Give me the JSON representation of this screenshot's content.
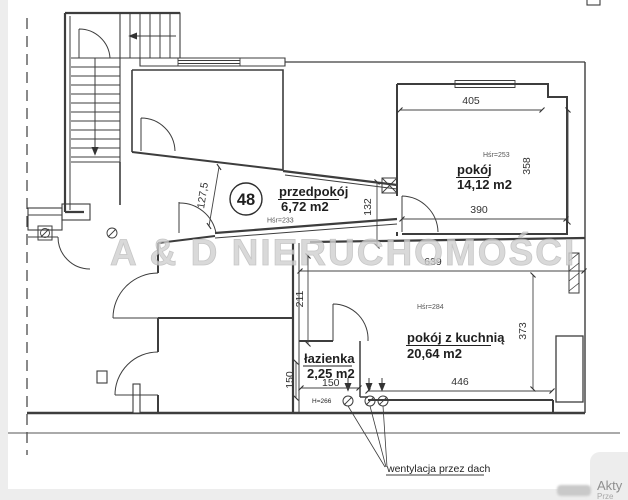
{
  "plan": {
    "watermark": "A & D NIERUCHOMOŚCI",
    "unit_badge": "48",
    "rooms": {
      "przedpokoj": {
        "name": "przedpokój",
        "area": "6,72 m2",
        "height": "Hśr=233"
      },
      "pokoj": {
        "name": "pokój",
        "area": "14,12 m2",
        "height": "Hśr=253"
      },
      "pokoj_z_kuchnia": {
        "name": "pokój z kuchnią",
        "area": "20,64 m2",
        "height": "Hśr=284"
      },
      "lazienka": {
        "name": "łazienka",
        "area": "2,25 m2",
        "height": "H=266",
        "width_dim": "150",
        "depth_dim": "150"
      }
    },
    "dimensions": {
      "pokoj_top": "405",
      "pokoj_right": "358",
      "pokoj_bottom": "390",
      "przedpokoj_pokoj_wall": "132",
      "przedpokoj_width": "127,5",
      "pzk_top": "639",
      "pzk_right": "373",
      "pzk_left_nook": "211",
      "pzk_bottom": "446"
    },
    "notes": {
      "ventilation": "wentylacja przez dach"
    },
    "os_overlay": {
      "line1": "Akty",
      "line2": "Prze"
    }
  }
}
